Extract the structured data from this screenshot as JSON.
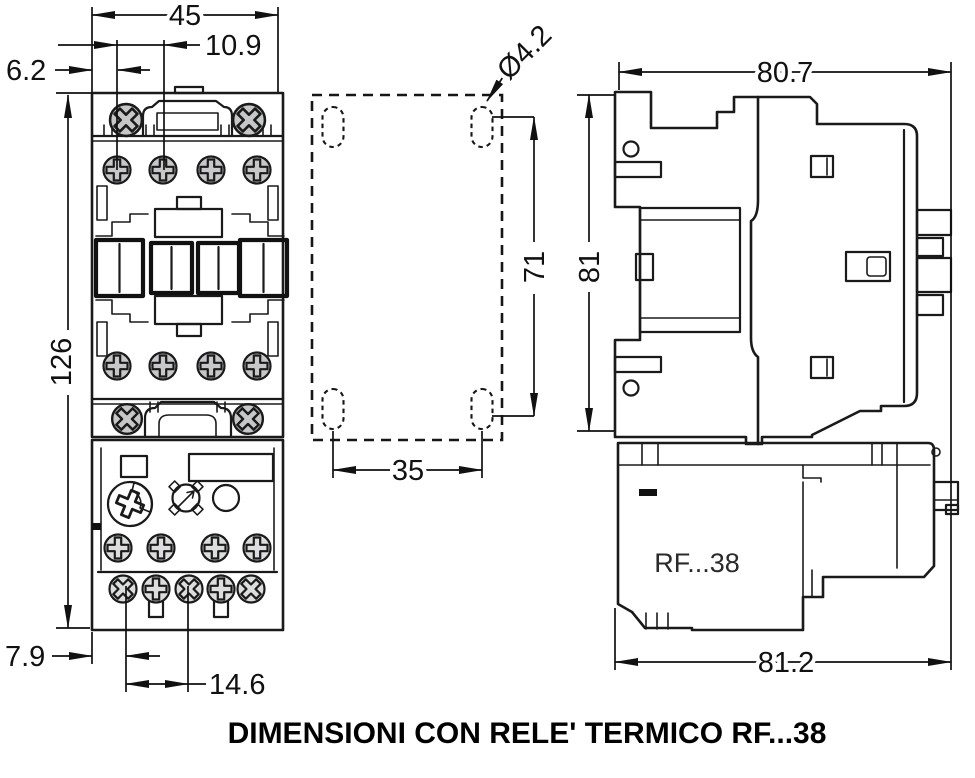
{
  "caption": "DIMENSIONI CON RELE' TERMICO RF...38",
  "front_view": {
    "dimensions": {
      "top_width": "45",
      "pole_pitch": "10.9",
      "edge_offset": "6.2",
      "overall_height": "126",
      "bottom_edge_offset": "7.9",
      "bottom_terminal_pitch": "14.6"
    }
  },
  "drilling_plan": {
    "hole_diameter": "Ø4.2",
    "vertical_pitch": "71",
    "horizontal_pitch": "35"
  },
  "side_view": {
    "depth_without_relay": "80.7",
    "height": "81",
    "depth_with_relay": "81.2",
    "relay_label": "RF...38"
  },
  "colors": {
    "contactor_fill": "#c6c7c9",
    "relay_fill": "#dcddde",
    "line": "#1a1a1a",
    "background": "#ffffff"
  }
}
